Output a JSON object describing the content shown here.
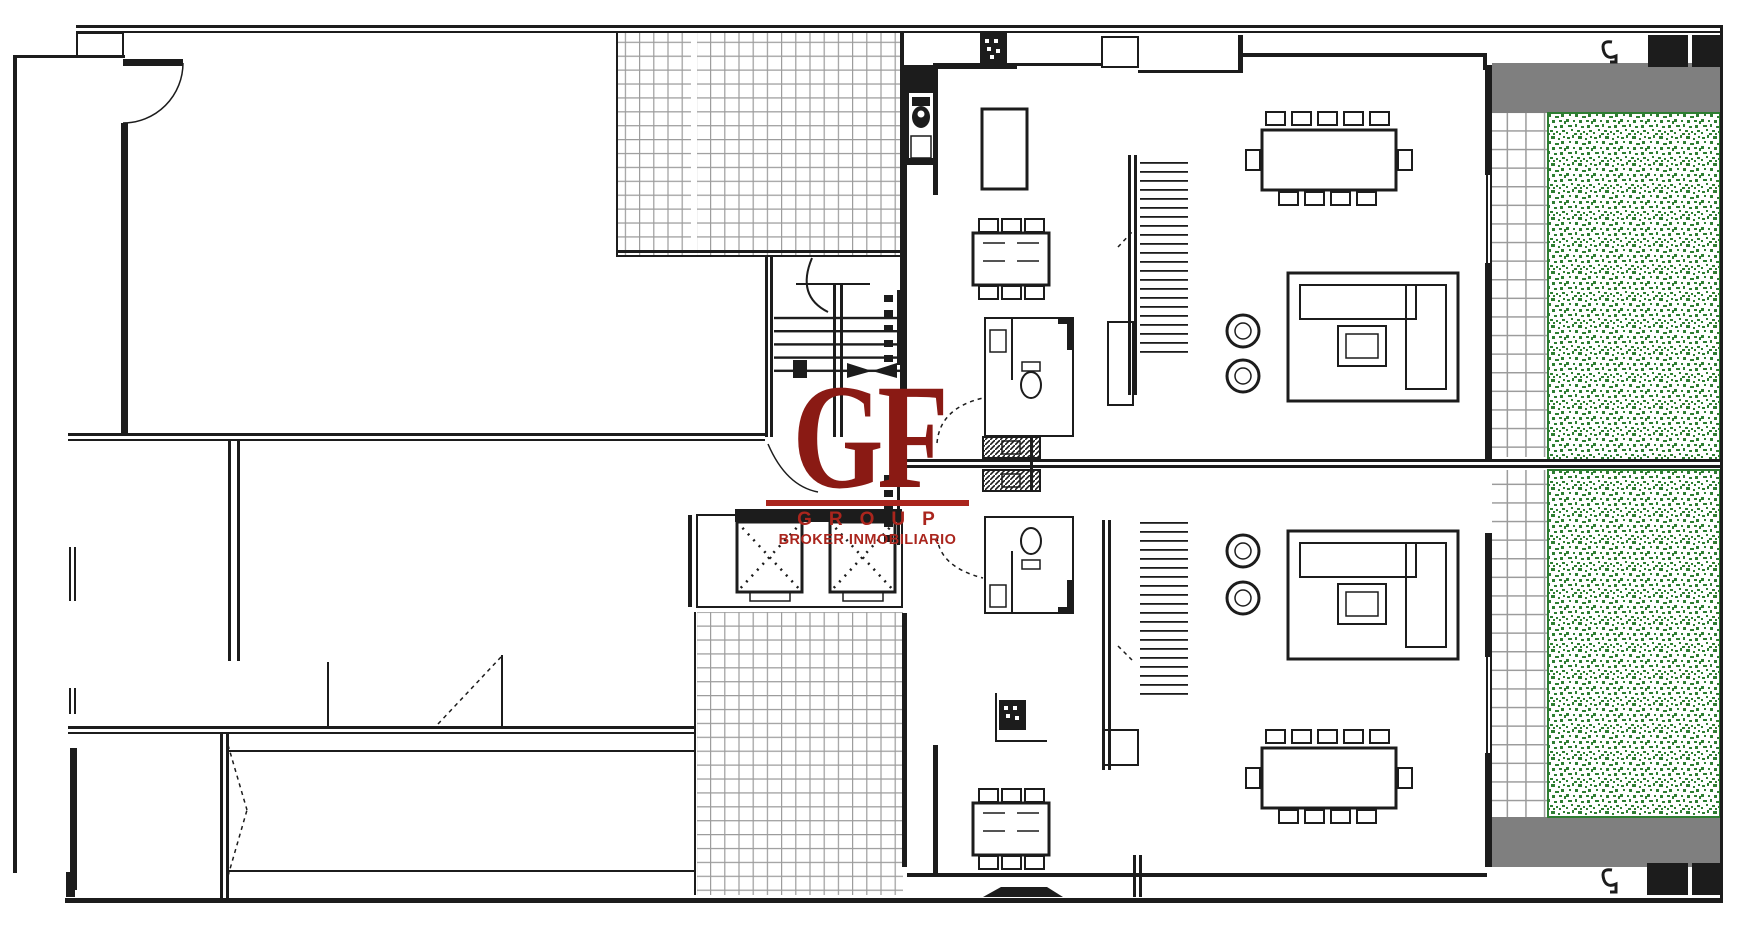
{
  "watermark": {
    "initials": "GF",
    "group_label": "GROUP",
    "tagline": "BROKER INMOBILIARIO"
  },
  "colors": {
    "background": "#ffffff",
    "wall": "#1c1c1c",
    "tile_line": "#9c9c9c",
    "paving_gray": "#7f7f7f",
    "garden_green": "#2e7d32",
    "watermark_dark": "#8a1a14",
    "watermark_red": "#aa251d"
  }
}
